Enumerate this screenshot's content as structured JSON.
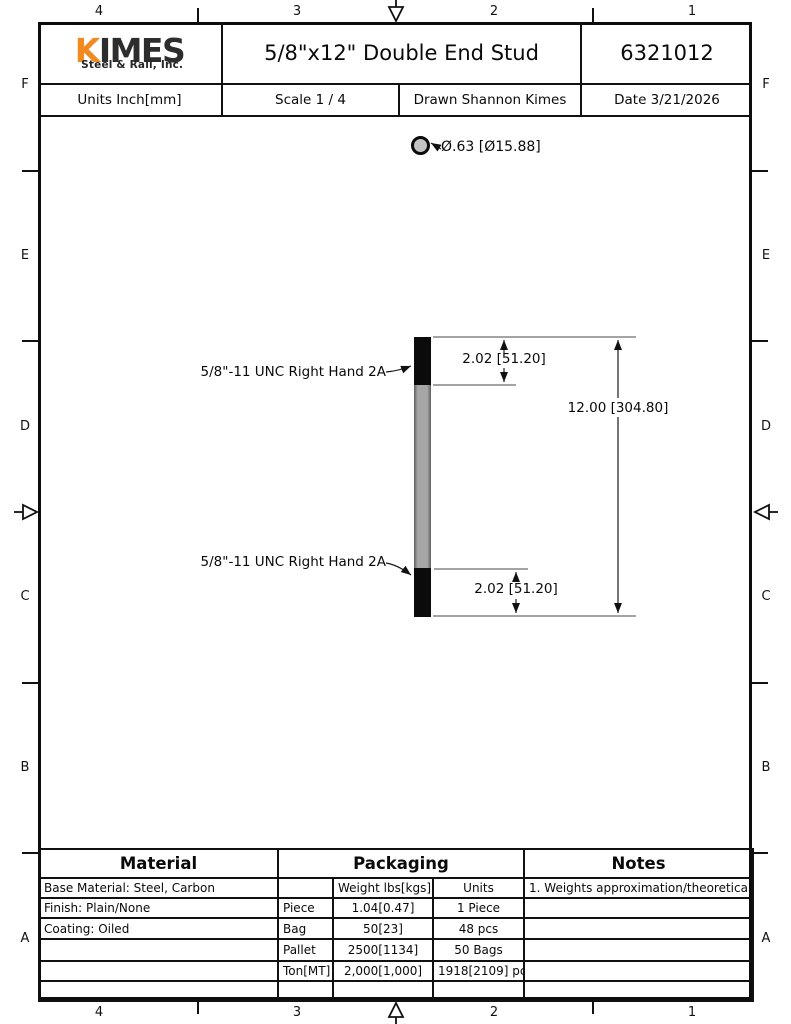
{
  "sheet": {
    "zone_cols": [
      "4",
      "3",
      "2",
      "1"
    ],
    "zone_rows": [
      "F",
      "E",
      "D",
      "C",
      "B",
      "A"
    ]
  },
  "title_block": {
    "logo_k": "K",
    "logo_rest": "IMES",
    "logo_sub": "Steel & Rail, Inc.",
    "title": "5/8\"x12\" Double End Stud",
    "part_number": "6321012",
    "units": "Units Inch[mm]",
    "scale": "Scale 1 / 4",
    "drawn": "Drawn Shannon Kimes",
    "date": "Date 3/21/2026"
  },
  "drawing": {
    "diameter_callout": "Ø.63 [Ø15.88]",
    "thread_callout_top": "5/8\"-11 UNC Right Hand 2A",
    "thread_callout_bottom": "5/8\"-11 UNC Right Hand 2A",
    "thread_length_top": "2.02 [51.20]",
    "thread_length_bottom": "2.02 [51.20]",
    "overall_length": "12.00 [304.80]"
  },
  "material": {
    "header": "Material",
    "base": "Base Material: Steel, Carbon",
    "finish": "Finish: Plain/None",
    "coating": "Coating: Oiled"
  },
  "packaging": {
    "header": "Packaging",
    "weight_header": "Weight lbs[kgs]",
    "units_header": "Units",
    "rows": [
      {
        "label": "Piece",
        "weight": "1.04[0.47]",
        "units": "1 Piece"
      },
      {
        "label": "Bag",
        "weight": "50[23]",
        "units": "48 pcs"
      },
      {
        "label": "Pallet",
        "weight": "2500[1134]",
        "units": "50 Bags"
      },
      {
        "label": "Ton[MT]",
        "weight": "2,000[1,000]",
        "units": "1918[2109] pcs"
      }
    ]
  },
  "notes": {
    "header": "Notes",
    "note1": "1. Weights approximation/theoretical."
  },
  "colors": {
    "accent_orange": "#F18A21",
    "ink": "#111111",
    "steel_gray": "#9B9B9B"
  }
}
